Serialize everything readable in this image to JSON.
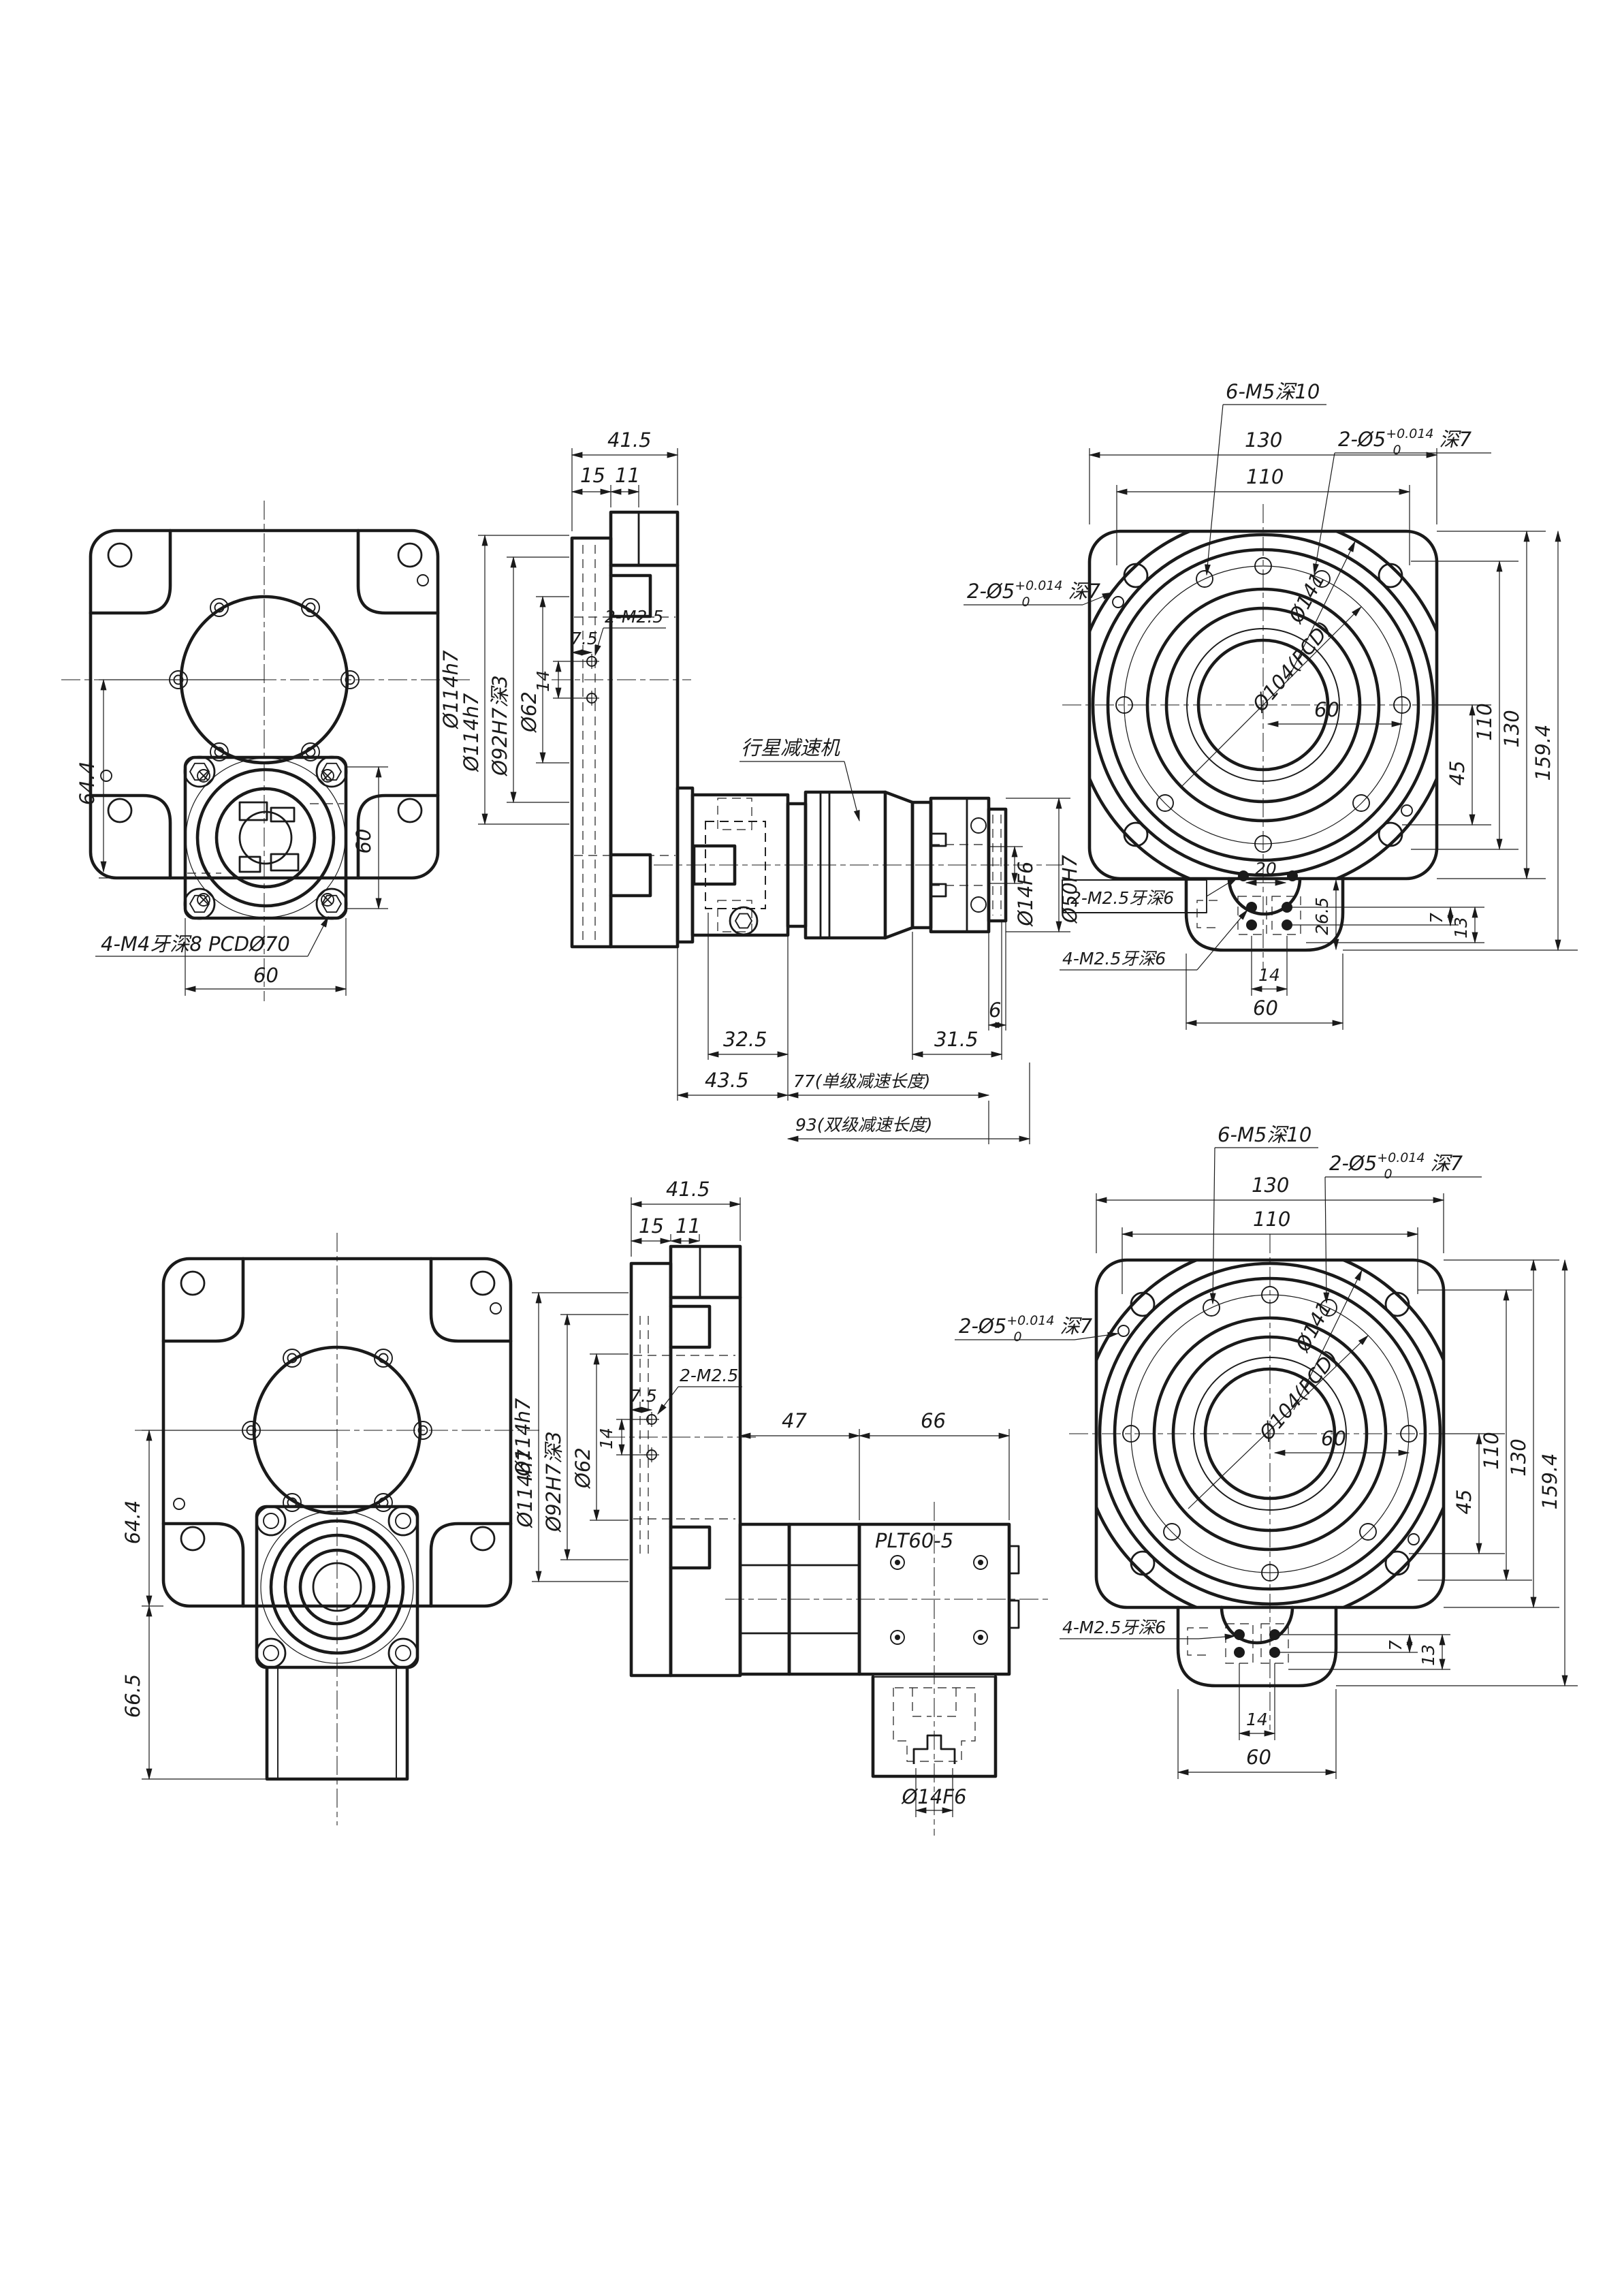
{
  "page": {
    "background": "#ffffff",
    "line_color": "#1a1a1a",
    "type": "mechanical-cad-drawing"
  },
  "labels": {
    "planetary_reducer": "行星减速机",
    "gearbox_model": "PLT60-5",
    "m4_pcd": "4-M4牙深8 PCDØ70",
    "m5_holes": "6-M5深10",
    "pin_prefix": "2-Ø5",
    "pin_tol_upper": "+0.014",
    "pin_tol_lower": "0",
    "pin_suffix": "深7",
    "m25_pair": "2-M2.5",
    "m25_pair_deep": "2-M2.5牙深6",
    "m25_quad_deep": "4-M2.5牙深6",
    "dia_114": "Ø114h7",
    "dia_92": "Ø92H7深3",
    "dia_62": "Ø62",
    "dia_104_pcd": "Ø104(PCD)",
    "dia_141": "Ø141",
    "dia_50": "Ø50H7",
    "dia_14": "Ø14F6",
    "len_single": "77(单级减速长度)",
    "len_double": "93(双级减速长度)"
  },
  "dims": {
    "d60": "60",
    "d644": "64.4",
    "d665": "66.5",
    "d415": "41.5",
    "d15": "15",
    "d11": "11",
    "d75": "7.5",
    "d14": "14",
    "d325": "32.5",
    "d435": "43.5",
    "d315": "31.5",
    "d6": "6",
    "d130": "130",
    "d110": "110",
    "d45": "45",
    "d1594": "159.4",
    "d7": "7",
    "d13": "13",
    "d265": "26.5",
    "d20": "20",
    "d47": "47",
    "d66": "66"
  }
}
